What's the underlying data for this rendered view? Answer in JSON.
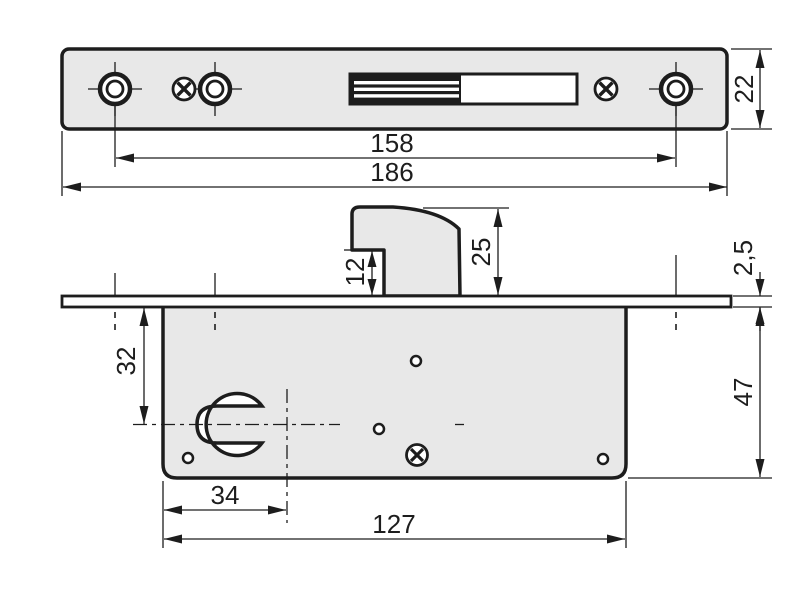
{
  "drawing": {
    "type": "technical-dimension-drawing",
    "subject": "hook-bolt mortise lock with euro profile cylinder",
    "units": "mm",
    "colors": {
      "metal_fill": "#e8e8e8",
      "line": "#1d1d1d",
      "background": "#ffffff"
    },
    "icons": [
      "countersunk-screw-hole-icon",
      "cross-screw-icon",
      "euro-cylinder-hole-icon",
      "hook-bolt"
    ]
  },
  "front_view": {
    "name": "faceplate-front-view",
    "dims": {
      "faceplate_length": "186",
      "screw_spacing": "158",
      "faceplate_width": "22"
    }
  },
  "side_view": {
    "name": "lock-body-side-view",
    "dims": {
      "body_length": "127",
      "cylinder_center_from_edge": "34",
      "cylinder_center_from_faceplate": "32",
      "body_height": "47",
      "faceplate_thickness": "2,5",
      "hook_projection": "25",
      "hook_notch_height": "12"
    }
  }
}
